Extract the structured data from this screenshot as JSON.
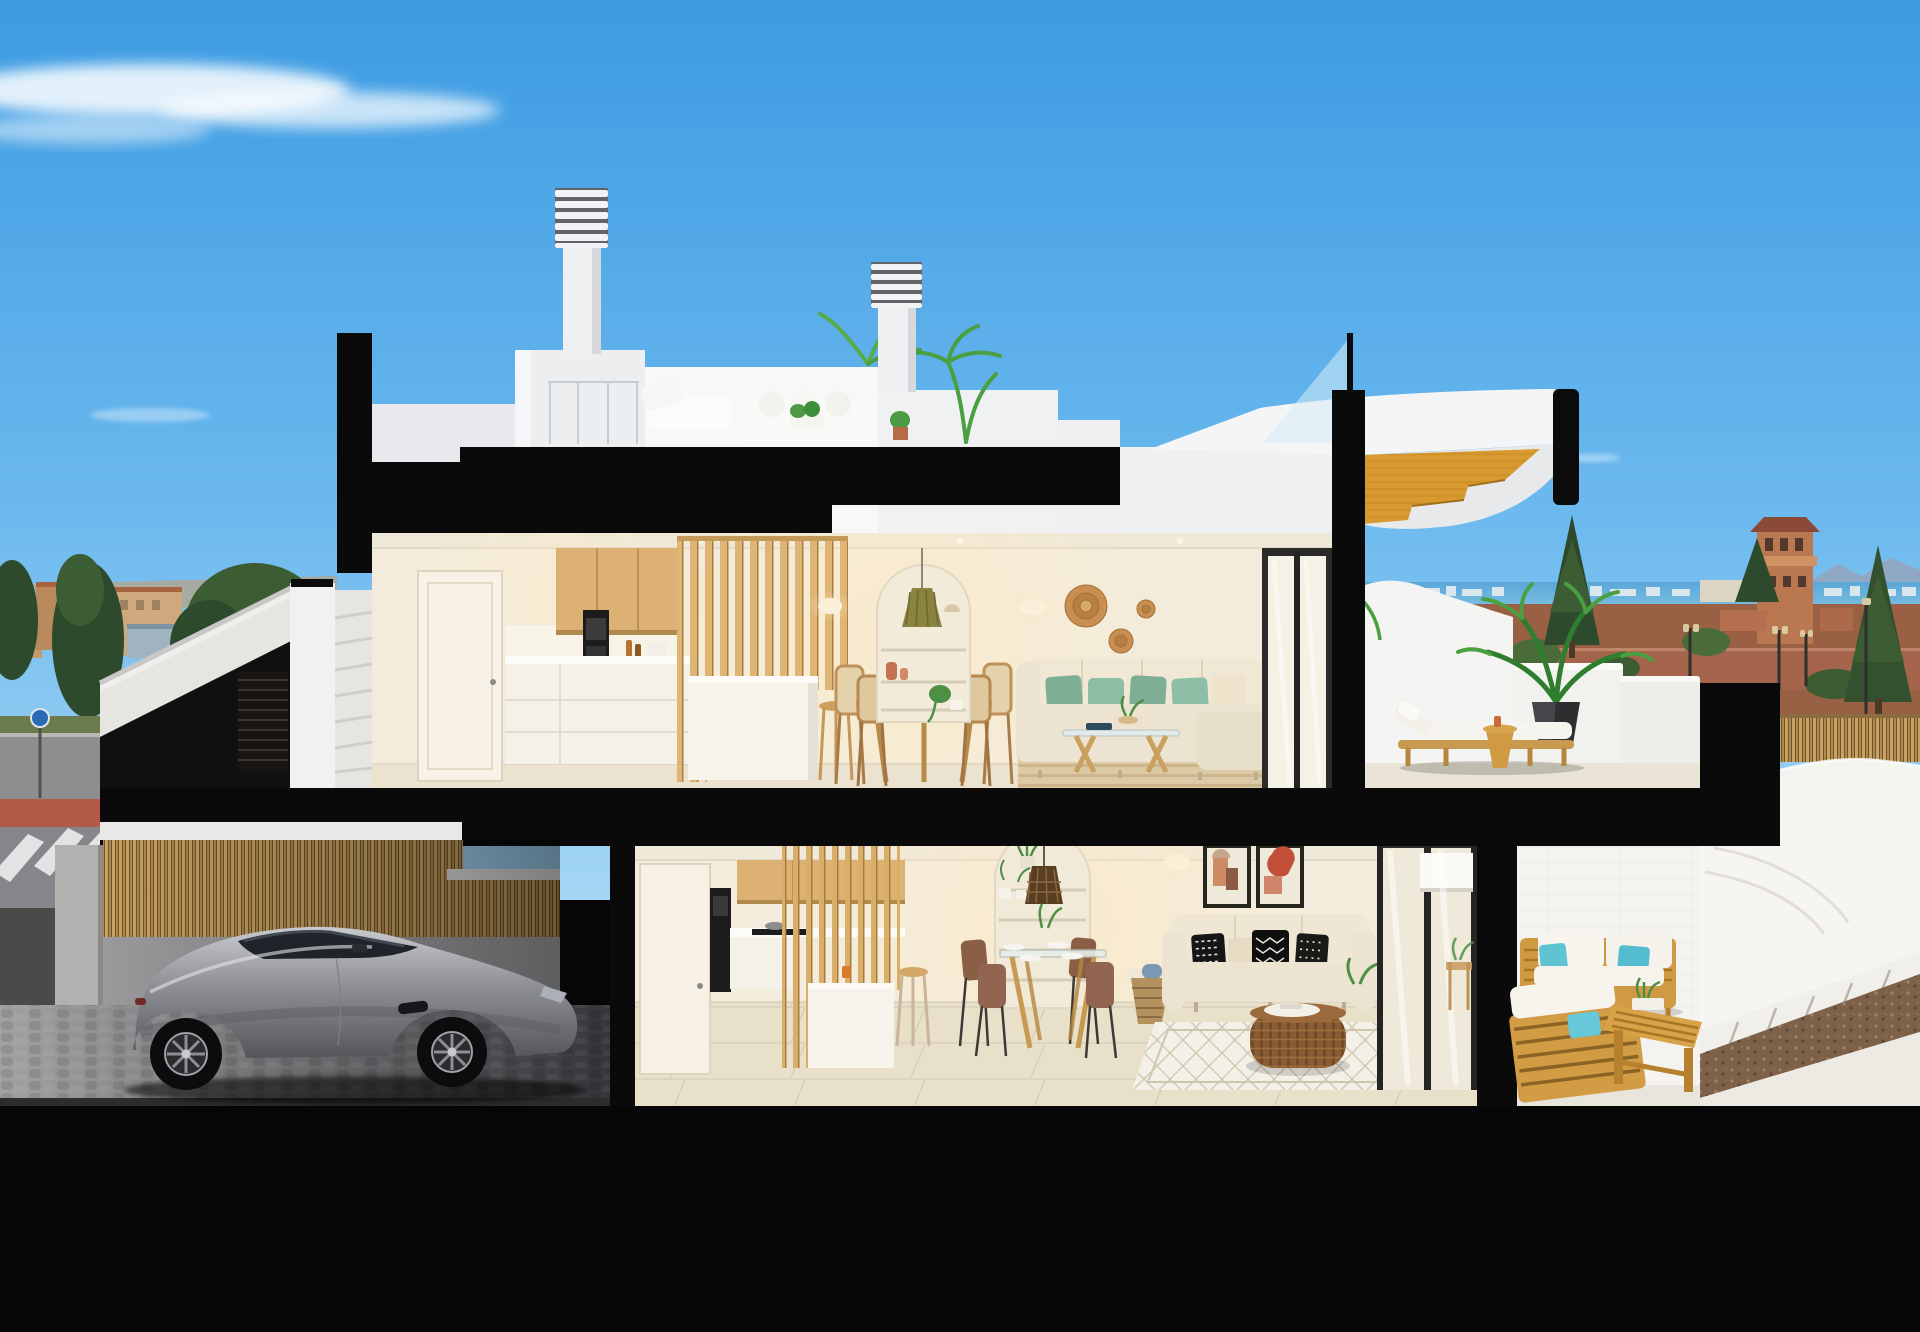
{
  "scene": {
    "title": "Cutaway cross-section 3D render of a modern two-storey coastal villa with roof terrace, garage and patios",
    "style": "photorealistic architectural visualization, dollhouse section view",
    "time_of_day": "daytime, clear blue sky with thin clouds",
    "environment": [
      "Mediterranean town skyline with terracotta roofs",
      "sea horizon with distant white city strip",
      "watchtower and pine trees",
      "street with red paved crossing and white crosswalk stripes",
      "bamboo slat boundary fences"
    ],
    "building": {
      "roof_terrace": [
        "two louvered chimney stacks",
        "white penthouse volumes",
        "glass balustrade",
        "white outdoor lounge sofa and chaise",
        "potted palms and planters",
        "sculptural white stair prow with ochre timber treads"
      ],
      "upper_floor": [
        "white interior door",
        "timber kitchen cabinets and slat screen",
        "black oven column",
        "kitchen island with stool",
        "round wood dining table with four chairs",
        "arched shelving niche with vases",
        "olive green pendant lamp",
        "two white wall sconces",
        "three rattan wall discs",
        "cream corner sofa with green cushions",
        "timber and glass coffee table",
        "striped beige rug",
        "black framed sliding glass door",
        "terrace with timber sun lounger, side table and palm in black pot"
      ],
      "entrance": [
        "external white staircase with sloped parapet",
        "dark slatted entrance gate",
        "concrete steps"
      ],
      "lower_floor": [
        "garage with silver sports coupe",
        "bamboo slat fence and grey cobbled floor",
        "kitchen with slat screen, island and bar stool",
        "glass dining table with four brown chairs",
        "arched niche with rattan pendant and plants",
        "two abstract terracotta artworks",
        "white wall sconce",
        "cream sofa with black-and-white patterned cushions",
        "round rattan coffee table",
        "white diamond-weave rug",
        "wicker basket with towels",
        "black framed sliding glass door with roller blind",
        "timber patio lounge set with white cushions and teal pillows",
        "slatted timber coffee bench",
        "curved white garden walls",
        "paver walkway and gravel strip"
      ]
    },
    "structure_note": "solid black poche marks cut walls and floor slabs of the section"
  },
  "palette": {
    "skyTop": "#3d9be2",
    "skyMid": "#6ab8ee",
    "skyLow": "#a5d6f4",
    "cloud": "#ffffff",
    "cut": "#0a0a0a",
    "blackBand": "#060606",
    "whiteBright": "#f7f8f9",
    "whiteSoft": "#eef0f2",
    "whiteShade": "#dfe1e4",
    "creamWall": "#f3ecdc",
    "creamCeil": "#efe9da",
    "floorUpper": "#ebe3d0",
    "floorLower": "#e9e0ca",
    "tileGrout": "#d8cfba",
    "woodSlat": "#deb574",
    "woodSlatDark": "#a87c3e",
    "woodCab": "#dcb173",
    "woodStair": "#d89a2e",
    "woodOutdoor": "#d09a43",
    "woodStool": "#cf9f5c",
    "sofaCream": "#ece4d0",
    "cushGreenA": "#7fae97",
    "cushGreenB": "#8cbfa6",
    "teal": "#5fc3d4",
    "rugBeige": "#dcc9a5",
    "rugStripe": "#cdb68c",
    "rugWhite": "#f3f0e7",
    "rattan": "#c98f52",
    "rattanDark": "#8a5c34",
    "pendantOlive": "#8a8440",
    "terracotta": "#c47051",
    "artRust": "#c24f38",
    "frameDark": "#26261f",
    "carSilver": "#97999e",
    "carDark": "#20242a",
    "wheelDark": "#0b0c0d",
    "fenceWood": "#b98e55",
    "fenceDark": "#6e5430",
    "garageWall": "#8f8f91",
    "garageFloorA": "#a2a2a4",
    "garageFloorB": "#36363a",
    "roadGrey": "#8e8e90",
    "roadRed": "#b35948",
    "grass": "#6d7c4e",
    "townTan": "#c49a6e",
    "townRoof": "#a8643f",
    "shedBlue": "#9fb3c0",
    "treeDark": "#2e4a2c",
    "treeMid": "#3c5c34",
    "palmGreen": "#4aa040",
    "palmDeep": "#2f7e2f",
    "sea": "#5aa7d8",
    "seaLight": "#7bbfe2",
    "skyline": "#d8e6ee",
    "mountain": "#8fa8c4",
    "coastRed": "#9a6044",
    "towerTerra": "#b97850",
    "gravel": "#7d6148",
    "glass": "#d6ecf8",
    "ovenDark": "#1c1c1c",
    "blindWhite": "#fbfaf6"
  }
}
